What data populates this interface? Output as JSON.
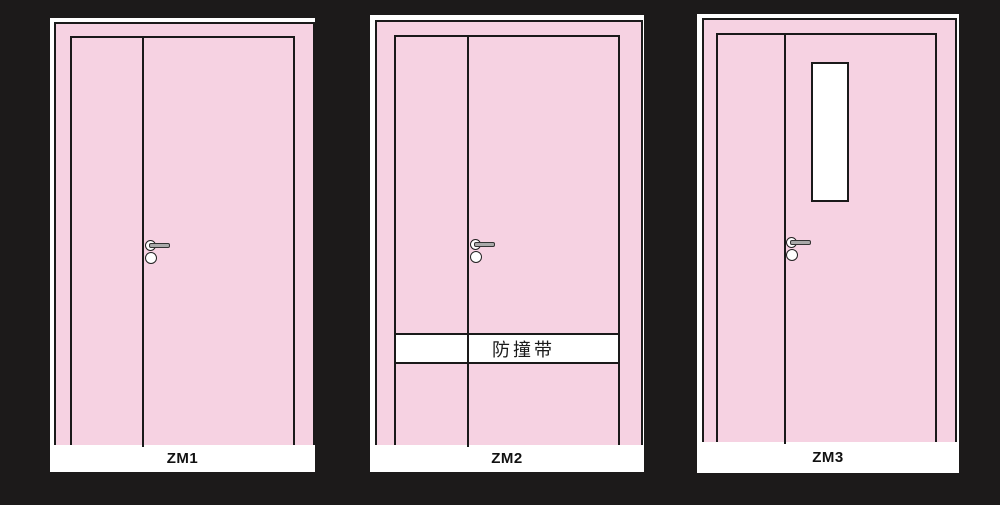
{
  "colors": {
    "background": "#1c1a1a",
    "panel": "#ffffff",
    "door-pink": "#f6d2e2",
    "outline": "#1a1a1a",
    "hardware-gray": "#a9a9a9"
  },
  "doors": [
    {
      "label": "ZM1"
    },
    {
      "label": "ZM2",
      "band_label": "防撞带"
    },
    {
      "label": "ZM3"
    }
  ]
}
